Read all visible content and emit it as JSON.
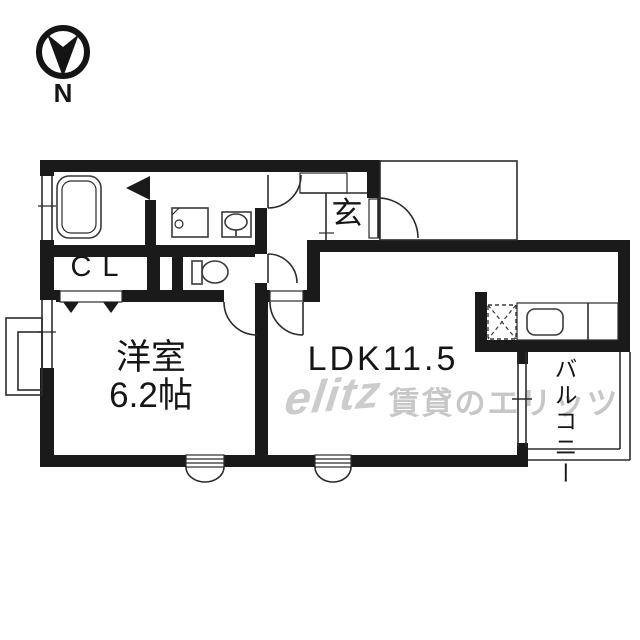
{
  "compass": {
    "label": "N"
  },
  "labels": {
    "closet": "CL",
    "entrance": "玄",
    "western_room_name": "洋室",
    "western_room_size": "6.2帖",
    "ldk": "LDK11.5",
    "balcony": "バルコニー"
  },
  "watermark": {
    "logo": "elitz",
    "text": "賃貸のエリッツ"
  },
  "fixtures": [
    "bathtub",
    "washing-machine-pan",
    "washbasin",
    "toilet",
    "gas-stove",
    "kitchen-sink"
  ],
  "colors": {
    "wall": "#1a1a1a",
    "line": "#2b2b2b",
    "watermark": "#c7c7c7",
    "background": "#ffffff"
  }
}
